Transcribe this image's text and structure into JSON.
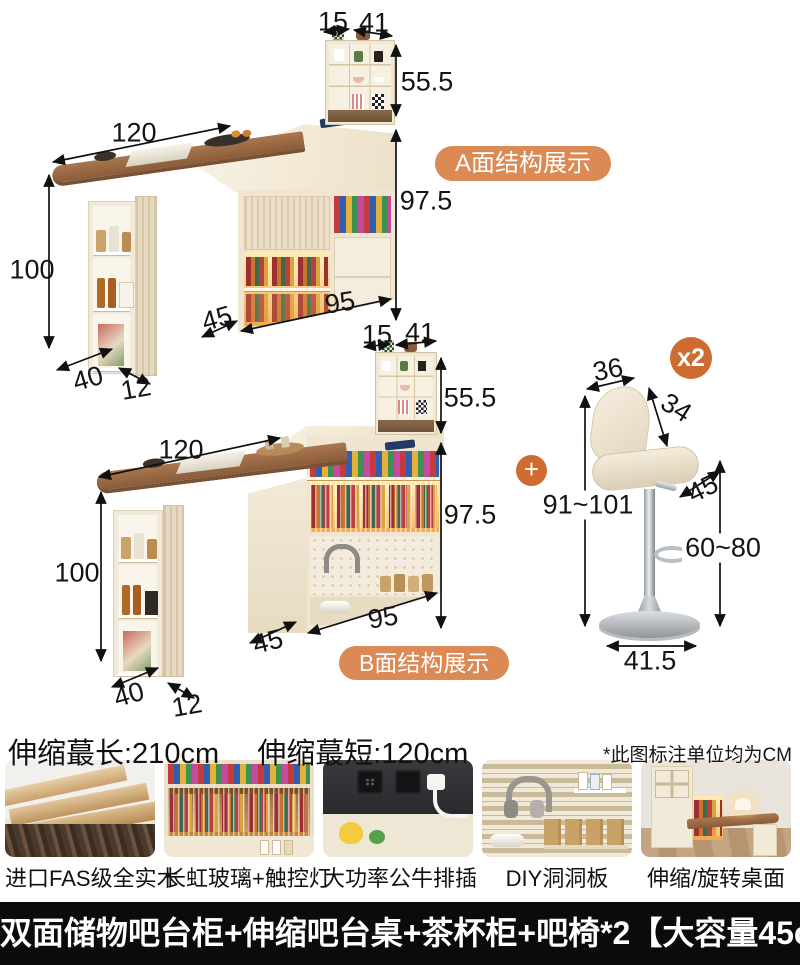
{
  "accent": {
    "pill_color": "#DB8A55",
    "circle_color": "#CE6B31"
  },
  "section_a": {
    "badge": "A面结构展示",
    "dims": {
      "top_depth": "15",
      "top_width": "41",
      "hutch_height": "55.5",
      "table_length": "120",
      "cabinet_height": "97.5",
      "column_height": "100",
      "cabinet_width": "95",
      "cabinet_depth": "45",
      "column_width": "40",
      "column_depth": "12"
    }
  },
  "section_b": {
    "badge": "B面结构展示",
    "dims": {
      "top_depth": "15",
      "top_width": "41",
      "hutch_height": "55.5",
      "table_length": "120",
      "cabinet_height": "97.5",
      "column_height": "100",
      "cabinet_width": "95",
      "cabinet_depth": "45",
      "column_width": "40",
      "column_depth": "12"
    }
  },
  "stool": {
    "quantity": "x2",
    "plus": "+",
    "dims": {
      "seat_width": "36",
      "back_height": "34",
      "seat_depth": "45",
      "total_height": "91~101",
      "footrest_height": "60~80",
      "base_diameter": "41.5"
    }
  },
  "specs": {
    "max_extension": "伸缩蕞长:210cm",
    "min_extension": "伸缩蕞短:120cm",
    "unit_note": "*此图标注单位均为CM"
  },
  "features": [
    {
      "caption": "进口FAS级全实木"
    },
    {
      "caption": "长虹玻璃+触控灯"
    },
    {
      "caption": "大功率公牛排插"
    },
    {
      "caption": "DIY洞洞板"
    },
    {
      "caption": "伸缩/旋转桌面"
    }
  ],
  "footer": {
    "title": "双面储物吧台柜+伸缩吧台桌+茶杯柜+吧椅*2【大容量45cm】"
  }
}
